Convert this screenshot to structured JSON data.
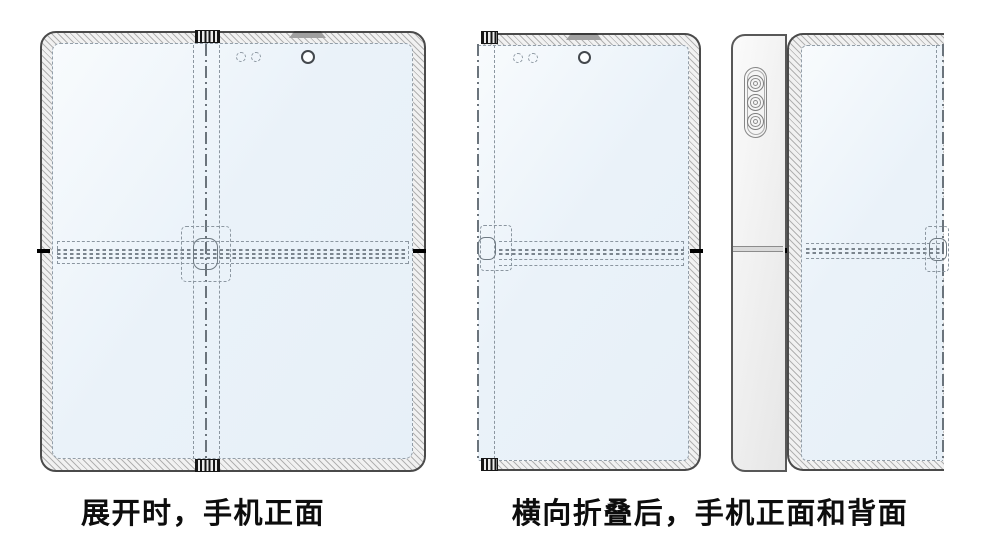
{
  "figure": {
    "views": [
      {
        "id": "unfolded-front",
        "caption": "展开时，手机正面"
      },
      {
        "id": "folded-front-and-back",
        "caption": "横向折叠后，手机正面和背面"
      }
    ]
  },
  "colors": {
    "background": "#ffffff",
    "screen_tint": "#e9f1f8",
    "bezel_fill": "#f1f1f1",
    "hatch_line": "#9a9a9a",
    "outline": "#4a4a4a",
    "dashed_line": "#8b96a0",
    "caption_text": "#0d0d0d"
  }
}
